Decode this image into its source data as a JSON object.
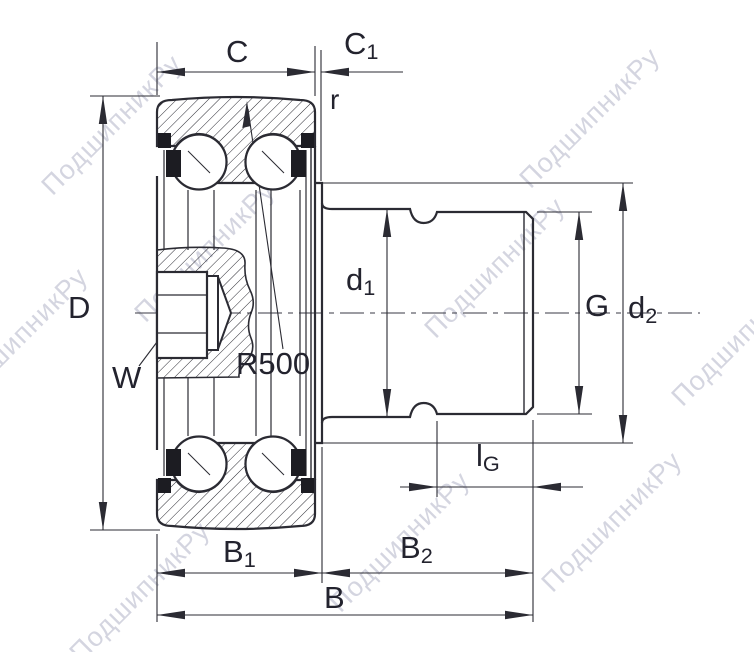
{
  "watermark": "ПодшипникРу",
  "colors": {
    "line": "#2b2b33",
    "label": "#23232e",
    "watermark": "#9b9eb8",
    "background": "#ffffff"
  },
  "labels": {
    "C": {
      "base": "C",
      "sub": ""
    },
    "C1": {
      "base": "C",
      "sub": "1"
    },
    "r": {
      "base": "r",
      "sub": ""
    },
    "D": {
      "base": "D",
      "sub": ""
    },
    "W": {
      "base": "W",
      "sub": ""
    },
    "R500": {
      "base": "R500",
      "sub": ""
    },
    "d1": {
      "base": "d",
      "sub": "1"
    },
    "G": {
      "base": "G",
      "sub": ""
    },
    "d2": {
      "base": "d",
      "sub": "2"
    },
    "lG": {
      "base": "l",
      "sub": "G"
    },
    "B1": {
      "base": "B",
      "sub": "1"
    },
    "B2": {
      "base": "B",
      "sub": "2"
    },
    "B": {
      "base": "B",
      "sub": ""
    }
  }
}
